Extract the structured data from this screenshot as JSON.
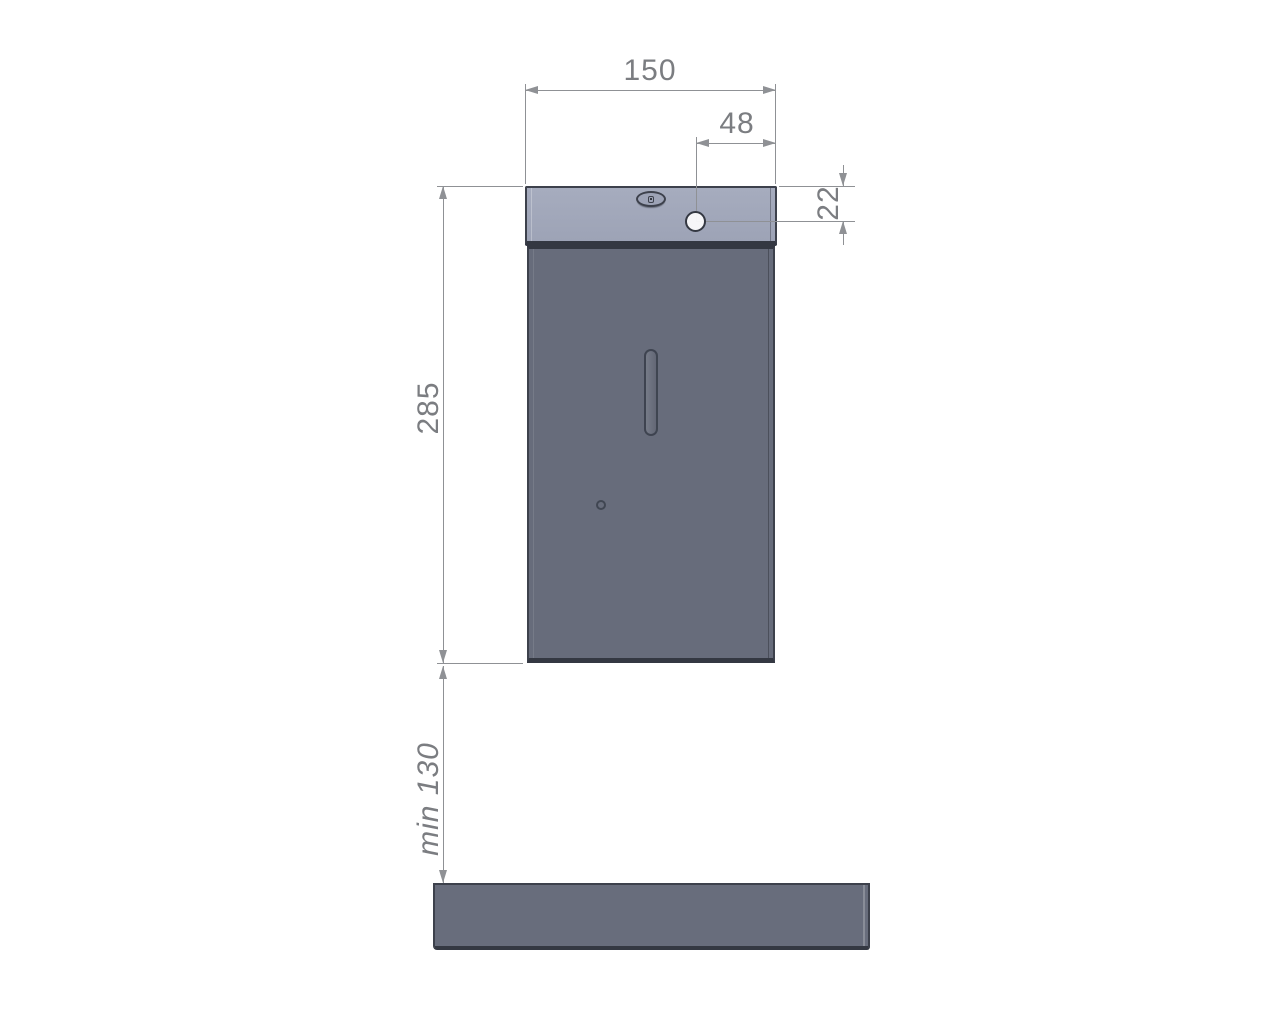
{
  "dimensions": {
    "width": "150",
    "hole_offset": "48",
    "hole_vertical": "22",
    "height": "285",
    "clearance": "min 130"
  },
  "icons": {
    "lock": "lock-icon",
    "mounting_hole": "mounting-hole",
    "dispense_slot": "dispense-slot-icon",
    "sensor": "sensor-dot-icon"
  },
  "colors": {
    "lid": "#9da3b6",
    "lidLight": "#a6acbe",
    "body": "#676c7b",
    "shelf": "#686d7c",
    "outline": "#3d414c",
    "outlineDark": "#343842",
    "dim": "#8f9195",
    "text": "#7b7d81",
    "hole": "#ffffff"
  }
}
